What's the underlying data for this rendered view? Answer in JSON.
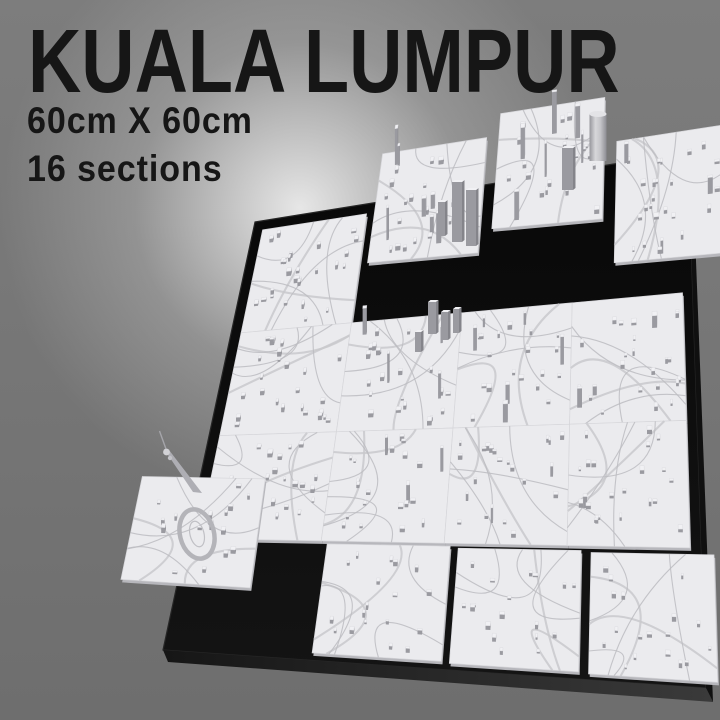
{
  "header": {
    "title": "KUALA LUMPUR",
    "size_label": "60cm X 60cm",
    "sections_label": "16 sections"
  },
  "model": {
    "description": "3D printed city map of Kuala Lumpur in 16 square sections on a dark tilted base, several sections exploded outward",
    "landmarks": [
      "kl-tower",
      "stadium-oval",
      "twin-towers",
      "cylindrical-skyscraper"
    ],
    "colors": {
      "background_top": "#7d7d7d",
      "background_bottom": "#6e6e6e",
      "glow": "#eeeeee",
      "text": "#161616",
      "base": "#080808",
      "base_edge": "#262626",
      "base_bevel": "#3a3a3a",
      "tile_top": "#ebebee",
      "tile_side": "#b7b7bc",
      "tile_seam": "#d6d6da",
      "road": "#bcbcc1",
      "road_major": "#c9c9cd",
      "building_top": "#f1f1f4",
      "building_side": "#9a9aa0",
      "building_side_dark": "#84848a",
      "tower_light": "#d7d7da",
      "tower_shaft": "#aeaeb4"
    }
  }
}
